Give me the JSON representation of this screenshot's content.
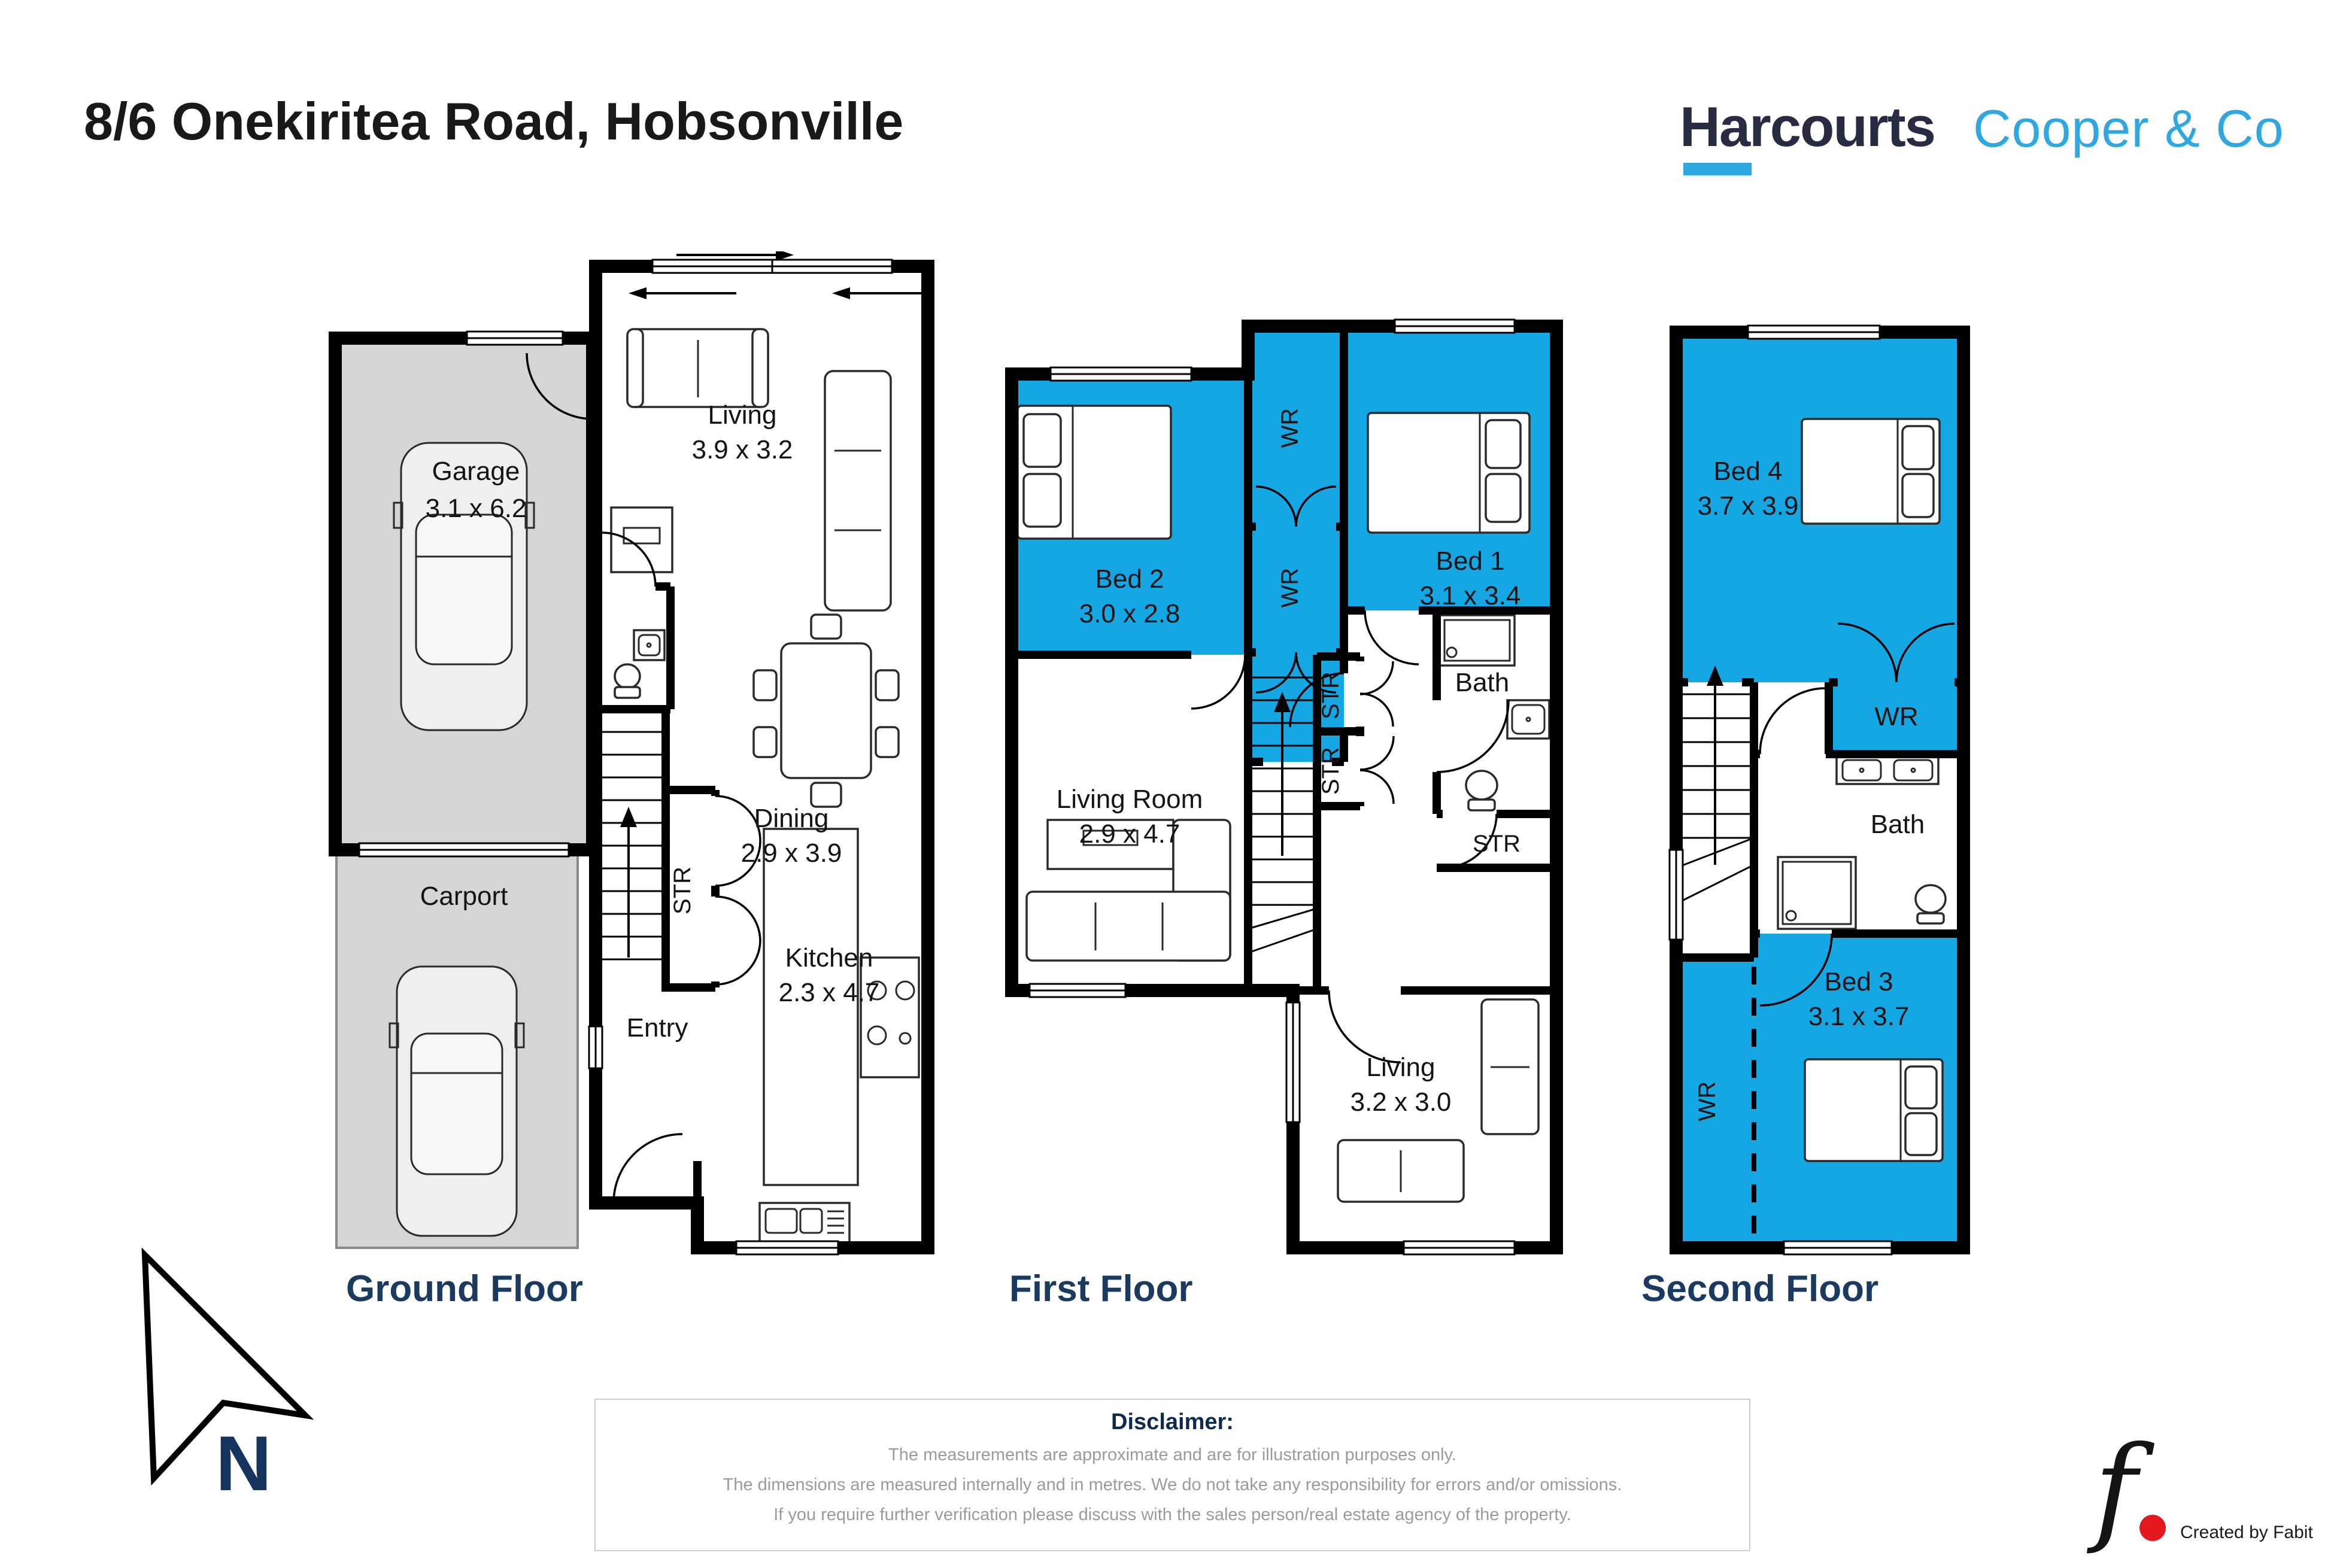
{
  "header": {
    "title": "8/6 Onekiritea Road, Hobsonville"
  },
  "brand": {
    "primary": "Harcourts",
    "secondary": "Cooper & Co",
    "navy": "#272c42",
    "blue": "#2fa8e2"
  },
  "palette": {
    "room_blue": "#14a7e3",
    "garage_gray": "#d5d5d5",
    "wall_black": "#000000",
    "floor_title_navy": "#1b3a60",
    "disclaimer_gray": "#9b9b9b",
    "fabit_red": "#e4191f"
  },
  "floors": [
    {
      "title": "Ground Floor",
      "rooms": [
        {
          "name": "Garage",
          "dims": "3.1 x 6.2"
        },
        {
          "name": "Carport",
          "dims": ""
        },
        {
          "name": "Living",
          "dims": "3.9 x 3.2"
        },
        {
          "name": "Dining",
          "dims": "2.9 x 3.9"
        },
        {
          "name": "Kitchen",
          "dims": "2.3 x 4.7"
        },
        {
          "name": "Entry",
          "dims": ""
        },
        {
          "name": "STR",
          "dims": ""
        }
      ]
    },
    {
      "title": "First Floor",
      "rooms": [
        {
          "name": "Bed 2",
          "dims": "3.0 x 2.8"
        },
        {
          "name": "WR",
          "dims": ""
        },
        {
          "name": "WR",
          "dims": ""
        },
        {
          "name": "Bed 1",
          "dims": "3.1 x 3.4"
        },
        {
          "name": "Living Room",
          "dims": "2.9 x 4.7"
        },
        {
          "name": "Bath",
          "dims": ""
        },
        {
          "name": "STR",
          "dims": ""
        },
        {
          "name": "STR",
          "dims": ""
        },
        {
          "name": "STR",
          "dims": ""
        },
        {
          "name": "Living",
          "dims": "3.2 x 3.0"
        }
      ]
    },
    {
      "title": "Second Floor",
      "rooms": [
        {
          "name": "Bed 4",
          "dims": "3.7 x 3.9"
        },
        {
          "name": "WR",
          "dims": ""
        },
        {
          "name": "Bath",
          "dims": ""
        },
        {
          "name": "Bed 3",
          "dims": "3.1 x 3.7"
        },
        {
          "name": "WR",
          "dims": ""
        }
      ]
    }
  ],
  "compass": {
    "label": "N"
  },
  "disclaimer": {
    "title": "Disclaimer:",
    "line1": "The measurements are approximate and are for illustration purposes only.",
    "line2": "The dimensions are measured internally and in metres. We do not take any responsibility for errors and/or omissions.",
    "line3": "If you require further verification please discuss with the sales person/real estate agency of the property."
  },
  "credit": {
    "monogram": "f",
    "label": "Created by Fabit"
  }
}
